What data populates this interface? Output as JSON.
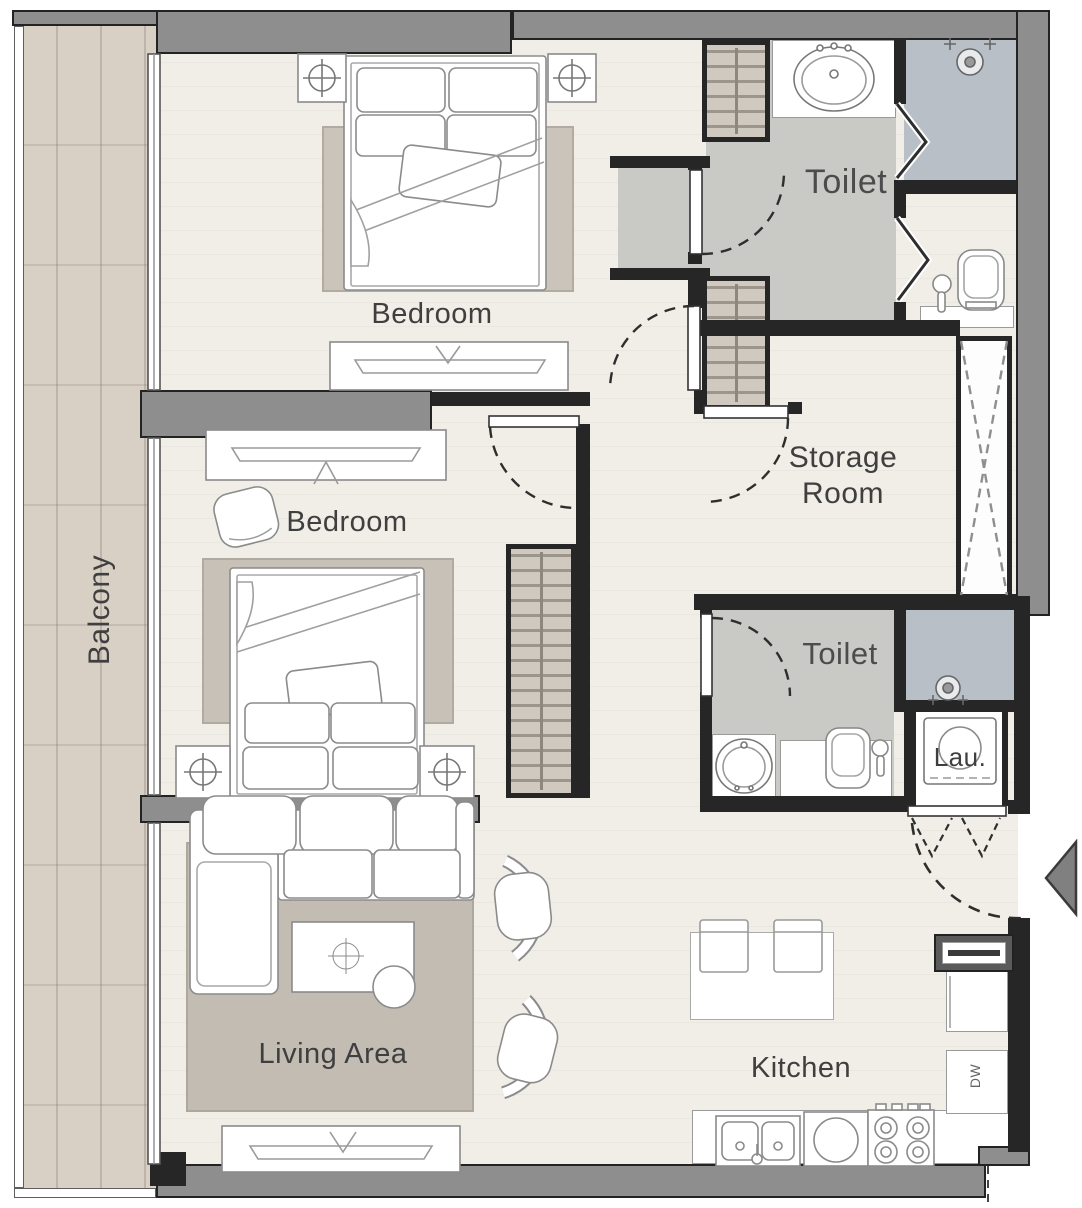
{
  "title": "Two-bedroom apartment floor plan",
  "rooms": {
    "balcony": {
      "label": "Balcony"
    },
    "bedroom_top": {
      "label": "Bedroom"
    },
    "bedroom_middle": {
      "label": "Bedroom"
    },
    "toilet_top": {
      "label": "Toilet"
    },
    "toilet_middle": {
      "label": "Toilet"
    },
    "storage": {
      "label": "Storage\nRoom"
    },
    "living": {
      "label": "Living Area"
    },
    "kitchen": {
      "label": "Kitchen"
    },
    "laundry": {
      "label": "Lau."
    }
  },
  "appliances": {
    "dishwasher_label": "DW"
  },
  "colors": {
    "exterior_wall_fill": "#8e8e8e",
    "wall_line": "#232323",
    "interior_wall": "#262626",
    "floor": "#f0eee7",
    "balcony_wood": "#d8d0c5",
    "wet_room_floor": "#c9c9c6",
    "shower_floor": "#b9bfc7",
    "rug": "#c6c0b7",
    "label_text": "#3f3f3f"
  }
}
